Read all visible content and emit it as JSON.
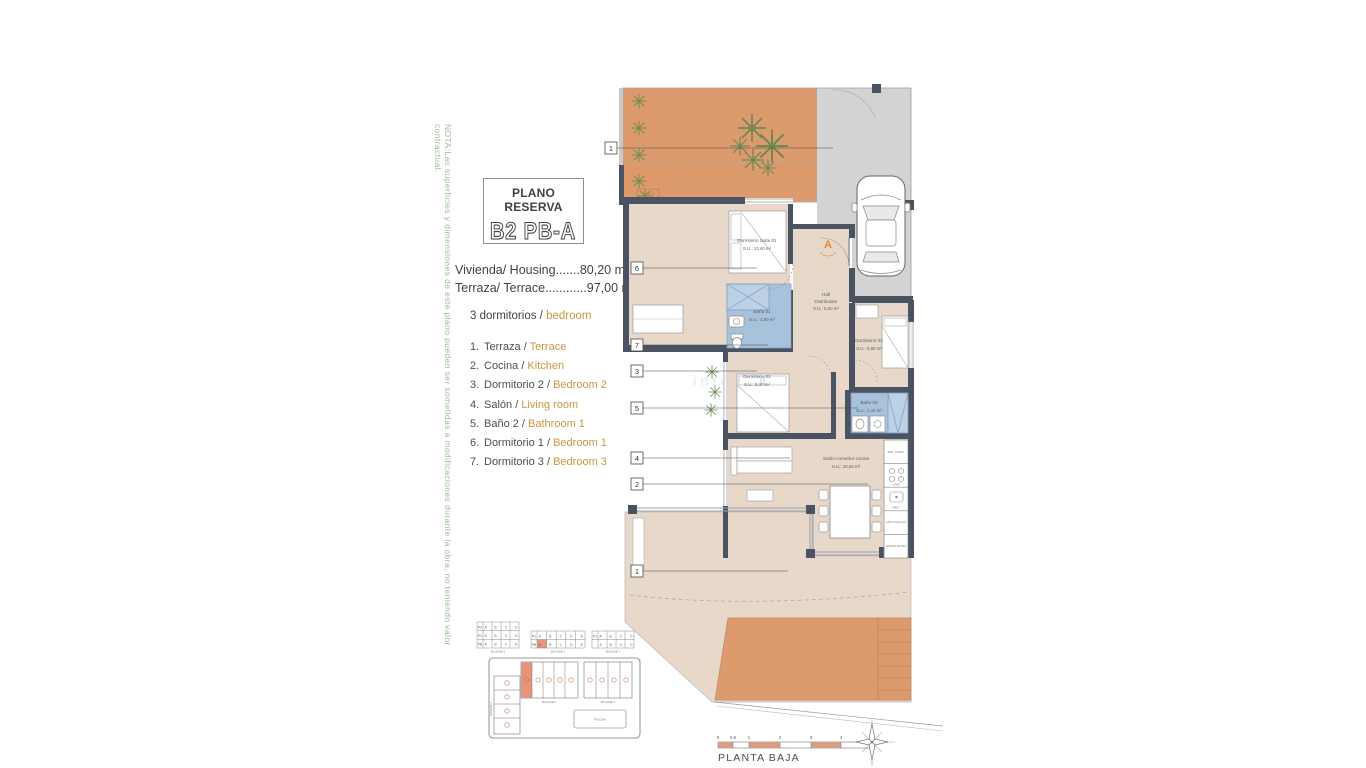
{
  "note": "NOTA:Las superficies y dimensiones de este plano pueden ser sometidas a modificaciones durante la obra, no teniendo valor contractual.",
  "title": {
    "kicker": "PLANO RESERVA",
    "code": "B2 PB-A"
  },
  "areas": {
    "line1": "Vivienda/ Housing.......80,20 m²",
    "line2": "Terraza/ Terrace............97,00 m²"
  },
  "bedrooms": {
    "es": "3 dormitorios /",
    "en": "bedroom"
  },
  "legend": [
    {
      "num": "1.",
      "es": "Terraza /",
      "en": "Terrace"
    },
    {
      "num": "2.",
      "es": "Cocina /",
      "en": "Kitchen"
    },
    {
      "num": "3.",
      "es": "Dormitorio 2 /",
      "en": "Bedroom 2"
    },
    {
      "num": "4.",
      "es": "Salón /",
      "en": "Living room"
    },
    {
      "num": "5.",
      "es": "Baño 2 /",
      "en": "Bathroom 1"
    },
    {
      "num": "6.",
      "es": "Dormitorio 1 /",
      "en": "Bedroom 1"
    },
    {
      "num": "7.",
      "es": "Dormitorio 3 /",
      "en": "Bedroom 3"
    }
  ],
  "plan": {
    "rooms": {
      "suite": {
        "name": "Dormitorio Suite 01",
        "area": "S.U.: 13,40 m²"
      },
      "hall": {
        "name": "Hall",
        "name2": "Distribuidor",
        "area": "S.U.: 5,00 m²"
      },
      "bath1": {
        "name": "Baño 01",
        "area": "S.U.: 3,60 m²"
      },
      "dorm3": {
        "name": "Dormitorio 03",
        "area": "S.U.: 6,60 m²"
      },
      "dorm2": {
        "name": "Dormitorio 02",
        "area": "S.U.: 9,10 m²"
      },
      "bath2": {
        "name": "Baño 02",
        "area": "S.U.: 3,10 m²"
      },
      "salon": {
        "name": "Salón-comedor-cocina",
        "area": "S.U.: 26,50 m²"
      }
    },
    "entrance": "A",
    "terrace_tag": "ASEO",
    "markers": [
      "1",
      "6",
      "7",
      "3",
      "5",
      "4",
      "2",
      "1"
    ],
    "kitchen_units": [
      "BAR. LAVAD.",
      "VITRO",
      "FREG.",
      "LAVA VAJILLAS",
      "HORNO MICRO"
    ],
    "watermark": "interhome"
  },
  "keyplan": {
    "grid1": {
      "rows": [
        "P2",
        "P1",
        "PB"
      ],
      "cells": "A B C D",
      "label": "BLOQUE 3"
    },
    "grid2": {
      "rows": [
        "P1",
        "PB"
      ],
      "cells": "A B C D E",
      "label": "BLOQUE 2"
    },
    "grid3": {
      "rows": [
        "P1",
        "PB"
      ],
      "cells": "A B C D",
      "label": "BLOQUE 1"
    },
    "siteplan": {
      "left_label": "BLOQUE 3",
      "mid_label": "BLOQUE 2",
      "right_label": "BLOQUE 1",
      "pool": "PISCINA"
    }
  },
  "footer": {
    "plan_name": "PLANTA BAJA",
    "scale_ticks": [
      "0",
      "0.5",
      "1",
      "2",
      "3",
      "4",
      "5"
    ]
  },
  "colors": {
    "terrace_orange": "#dd9a6c",
    "wall_dark": "#4a5362",
    "floor_beige": "#e8d8ca",
    "bath_blue": "#a8c2dc",
    "driveway_gray": "#d3d3d3",
    "accent_orange": "#c9963f",
    "entrance_orange": "#e08a2d",
    "note_green": "#96bd90",
    "keyplan_highlight": "#e8937b",
    "scalebar_pink": "#d79e86"
  }
}
